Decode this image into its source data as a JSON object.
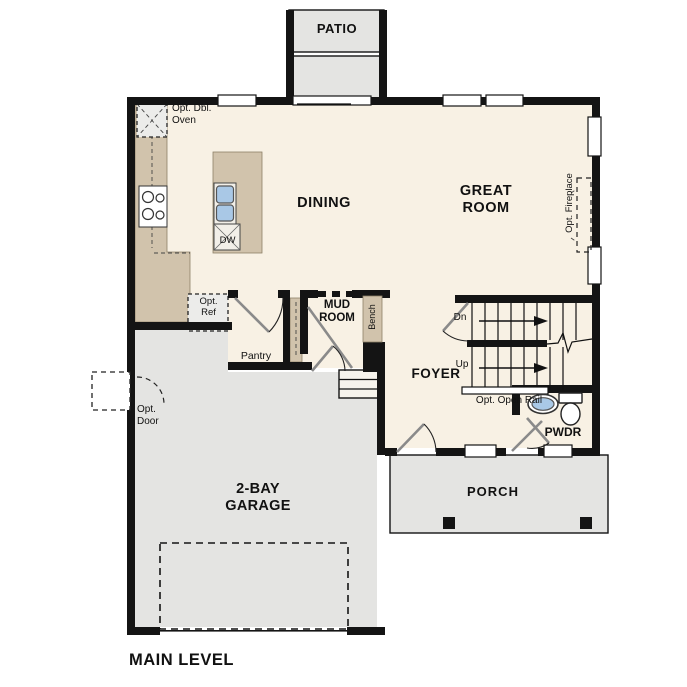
{
  "plan": {
    "title": "MAIN LEVEL",
    "labels": {
      "patio": "PATIO",
      "opt_dbl_oven": "Opt. Dbl. Oven",
      "dining": "DINING",
      "great_room": "GREAT ROOM",
      "opt_fireplace": "Opt. Fireplace",
      "dw": "DW",
      "opt_ref": "Opt. Ref",
      "pantry": "Pantry",
      "mud_room": "MUD ROOM",
      "bench": "Bench",
      "foyer": "FOYER",
      "stairs_dn": "Dn",
      "stairs_up": "Up",
      "opt_open_rail": "Opt. Open Rail",
      "pwdr": "PWDR",
      "opt_door": "Opt. Door",
      "garage": "2-BAY GARAGE",
      "porch": "PORCH"
    },
    "colors": {
      "floor": "#f8f1e4",
      "concrete": "#e4e4e2",
      "counter": "#d1c3ac",
      "wall": "#141414",
      "fixture_blue": "#a9c8e6",
      "optional_fill": "#ececea",
      "text": "#111111"
    }
  }
}
